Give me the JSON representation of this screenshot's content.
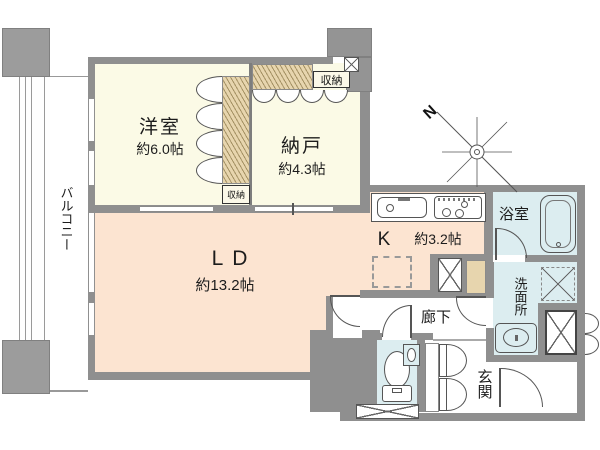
{
  "colors": {
    "wall": "#8f8f8f",
    "cream": "#fbfae6",
    "peach": "#fce4d1",
    "blue": "#dcedf0",
    "tan": "#e7d5ae"
  },
  "rooms": {
    "western": {
      "name": "洋室",
      "size": "約6.0帖"
    },
    "storage_room": {
      "name": "納戸",
      "size": "約4.3帖"
    },
    "living_dining": {
      "name": "LD",
      "size": "約13.2帖"
    },
    "kitchen": {
      "name": "K",
      "size": "約3.2帖"
    },
    "bathroom": {
      "name": "浴室"
    },
    "washroom": {
      "name": "洗面所"
    },
    "hallway": {
      "name": "廊下"
    },
    "entrance": {
      "name": "玄関"
    },
    "balcony": {
      "name": "バルコニー"
    }
  },
  "closets": {
    "upper": "収納",
    "side": "収納"
  },
  "compass": {
    "north": "N"
  }
}
